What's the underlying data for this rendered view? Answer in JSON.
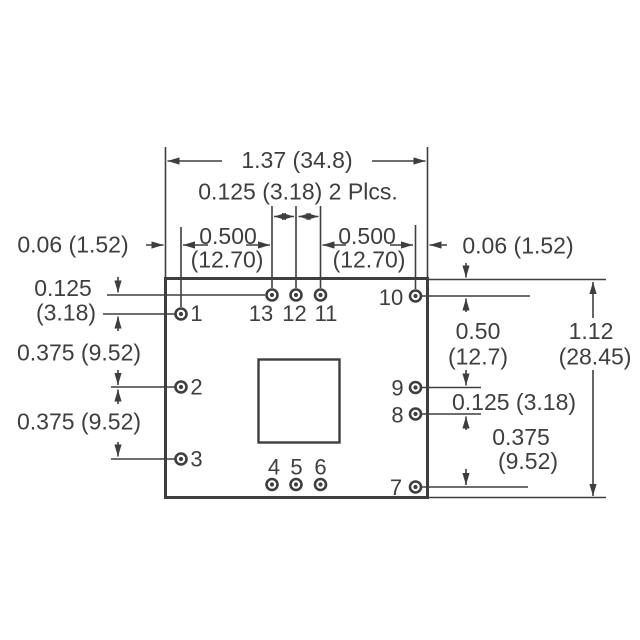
{
  "colors": {
    "ink": "#3e3e3e",
    "background": "#ffffff"
  },
  "dimensions": {
    "overall_width": "1.37 (34.8)",
    "top_pin_spacing": "0.125 (3.18) 2 Plcs.",
    "edge_offset_left": "0.06 (1.52)",
    "edge_offset_right": "0.06 (1.52)",
    "pitch_left_in": "0.500",
    "pitch_left_mm": "(12.70)",
    "pitch_right_in": "0.500",
    "pitch_right_mm": "(12.70)",
    "left_row1_in": "0.125",
    "left_row1_mm": "(3.18)",
    "left_span_1": "0.375 (9.52)",
    "left_span_2": "0.375 (9.52)",
    "right_span_top_in": "0.50",
    "right_span_top_mm": "(12.7)",
    "right_offset_mid": "0.125 (3.18)",
    "right_span_bottom_in": "0.375",
    "right_span_bottom_mm": "(9.52)",
    "overall_height_in": "1.12",
    "overall_height_mm": "(28.45)"
  },
  "pins": [
    {
      "label": "1"
    },
    {
      "label": "2"
    },
    {
      "label": "3"
    },
    {
      "label": "4"
    },
    {
      "label": "5"
    },
    {
      "label": "6"
    },
    {
      "label": "7"
    },
    {
      "label": "8"
    },
    {
      "label": "9"
    },
    {
      "label": "10"
    },
    {
      "label": "11"
    },
    {
      "label": "12"
    },
    {
      "label": "13"
    }
  ]
}
